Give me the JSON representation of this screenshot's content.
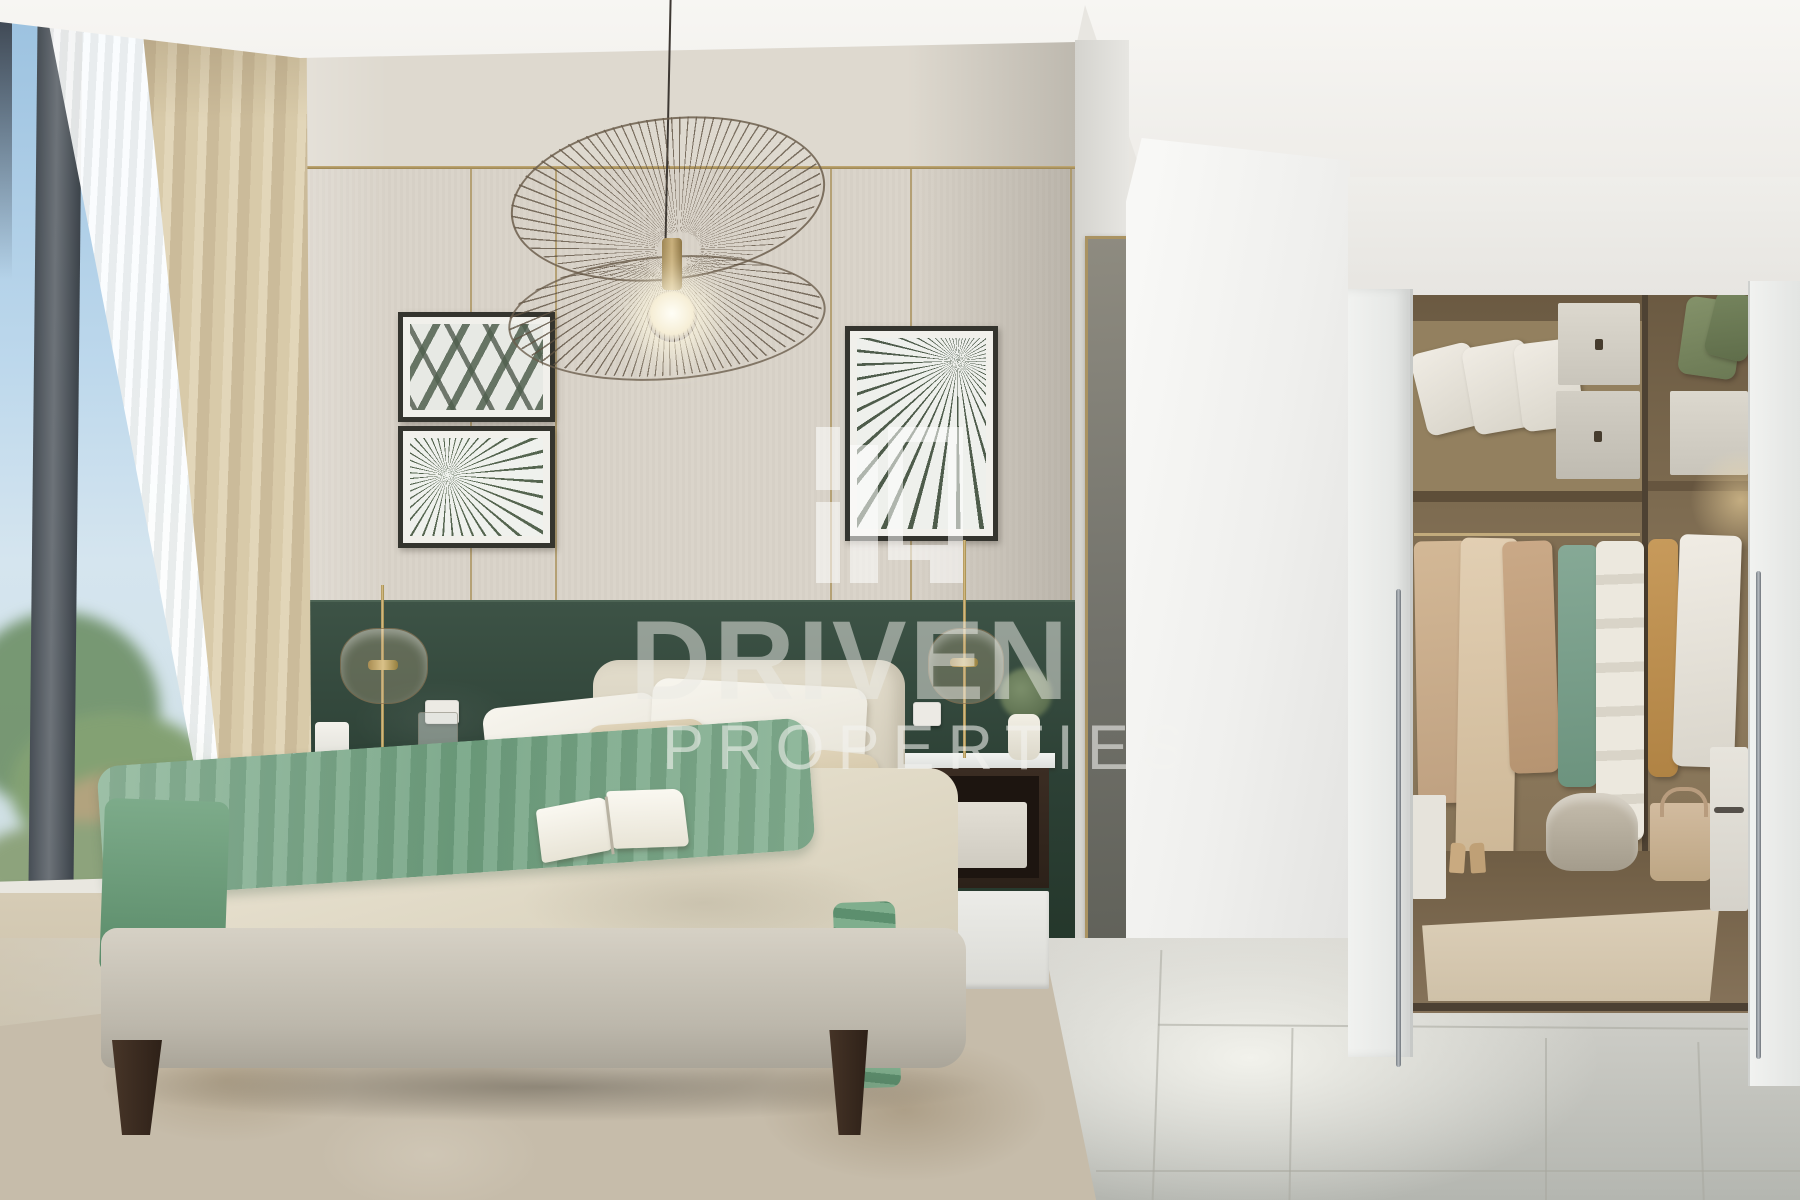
{
  "image": {
    "kind": "real-estate interior render photograph",
    "subject": "bedroom with bed, pendant wire lamp, gallery wall art, green velvet headboard wall and walk-in closet",
    "style": "contemporary beige and green interior"
  },
  "watermark": {
    "line1": "DRIVEN",
    "line2": "PROPERTIES",
    "logo": "driven-properties-logo",
    "color": "#ffffff",
    "opacity": 0.55
  },
  "palette": {
    "accent_green_wall": "#2c4035",
    "throw_green": "#7fae8d",
    "gold_trim": "#a89058",
    "wall_beige": "#d9d3c9",
    "curtain_beige": "#d8caa9",
    "duvet_cream": "#e9e3d3",
    "wood_dark": "#3b2d23",
    "closet_wood": "#8d7a5d",
    "floor_gray": "#cfcfc9",
    "sky_blue": "#9cc2e0"
  },
  "scene": {
    "left": [
      "window-sky-view",
      "window-frame",
      "sheer-curtain",
      "blackout-curtain"
    ],
    "center": [
      "pendant-wire-lamp",
      "gallery-frames-palm-art",
      "paneled-accent-wall",
      "green-velvet-band",
      "bed-with-green-throw",
      "open-book",
      "nightstand-left",
      "nightstand-right",
      "table-lamps",
      "area-rug"
    ],
    "right": [
      "gold-framed-mirror",
      "white-partition-wall",
      "walk-in-closet",
      "sliding-pocket-doors",
      "hanging-clothes",
      "shelf-pillows",
      "storage-boxes",
      "tile-floor"
    ]
  }
}
